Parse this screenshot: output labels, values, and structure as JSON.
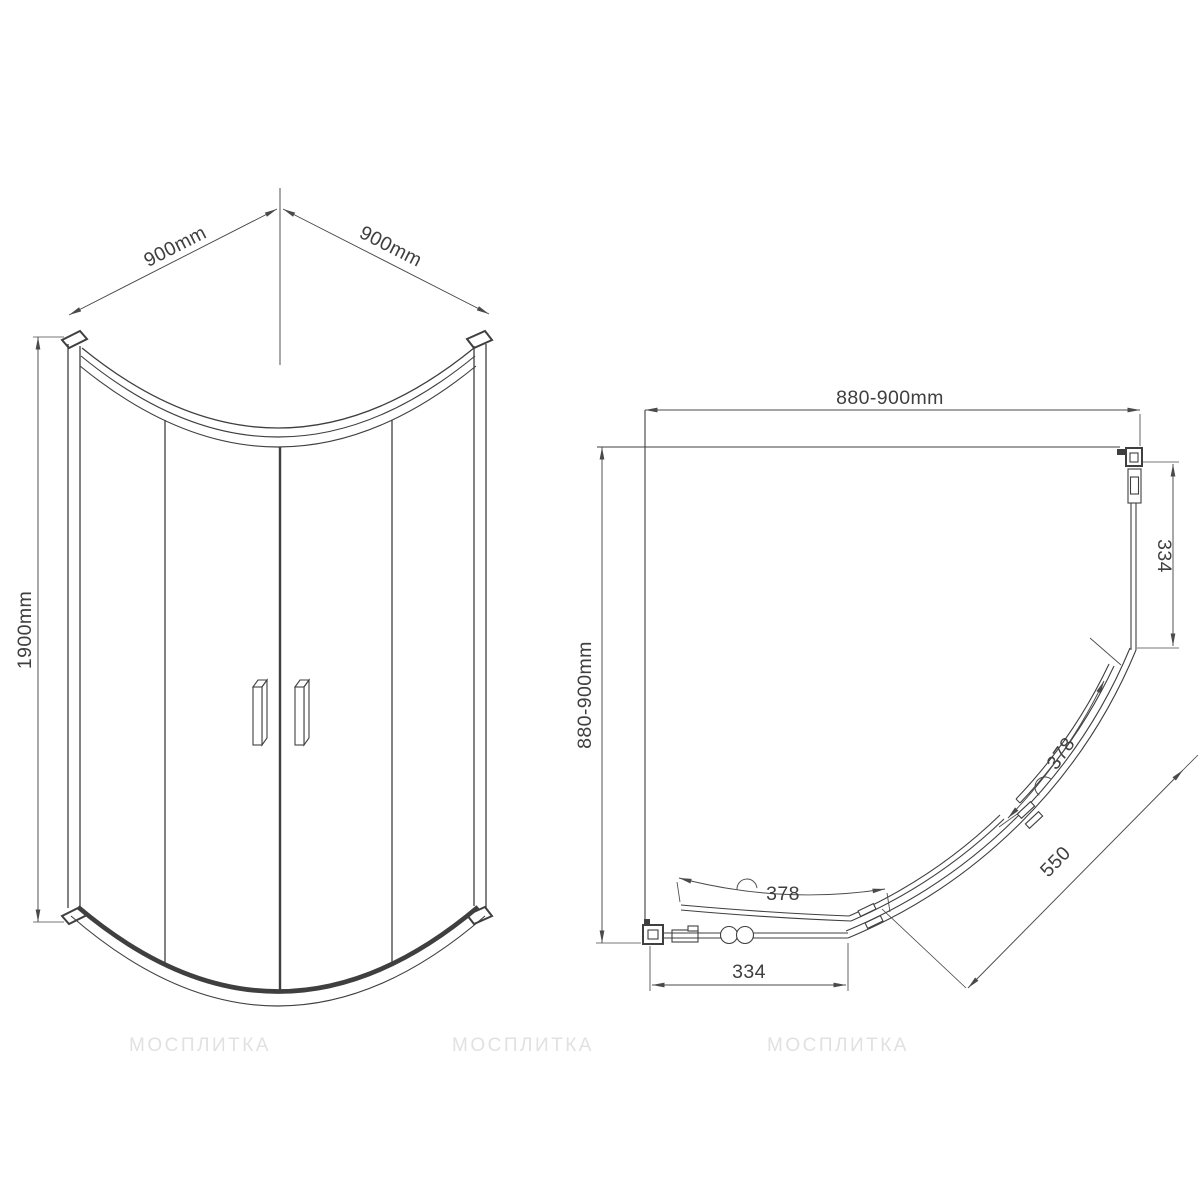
{
  "front_view": {
    "width_left_label": "900mm",
    "width_right_label": "900mm",
    "height_label": "1900mm"
  },
  "plan_view": {
    "width_label": "880-900mm",
    "depth_label": "880-900mm",
    "fixed_panel_right_label": "334",
    "fixed_panel_bottom_label": "334",
    "door_arc_upper_label": "378",
    "door_arc_lower_label": "378",
    "diagonal_label": "550"
  },
  "watermarks": [
    "МОСПЛИТКА",
    "МОСПЛИТКА",
    "МОСПЛИТКА"
  ],
  "colors": {
    "line": "#3f3f3f",
    "dimension": "#4a4a4a",
    "watermark": "#dcdcdc",
    "background": "#ffffff"
  }
}
